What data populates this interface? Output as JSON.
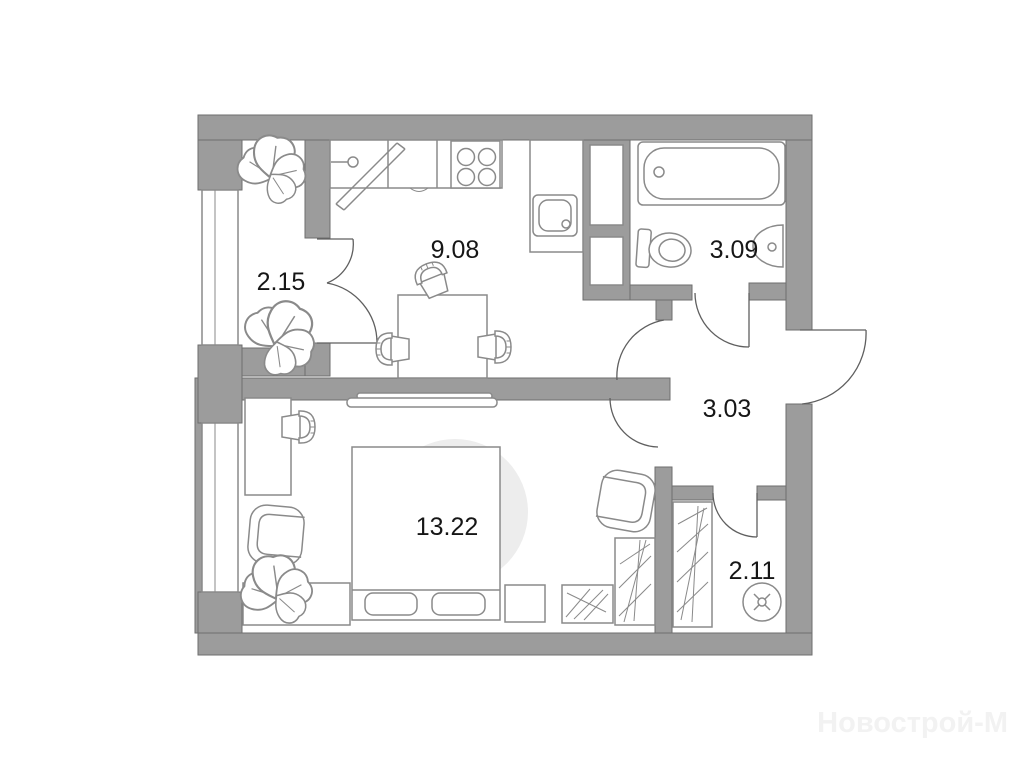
{
  "plan": {
    "type": "apartment-floor-plan",
    "rooms": {
      "balcony": {
        "name": "balcony",
        "area": "2.15"
      },
      "kitchen": {
        "name": "kitchen-living",
        "area": "9.08"
      },
      "bathroom": {
        "name": "bathroom",
        "area": "3.09"
      },
      "hallway": {
        "name": "hallway",
        "area": "3.03"
      },
      "bedroom": {
        "name": "bedroom",
        "area": "13.22"
      },
      "storage": {
        "name": "storage-closet",
        "area": "2.11"
      }
    },
    "fixtures": [
      "bathtub",
      "toilet",
      "wall-sink",
      "stove-4-burner",
      "kitchen-sink",
      "faucet",
      "drying-board",
      "dining-table",
      "chairs",
      "bed",
      "pillows",
      "rug",
      "desk",
      "armchair",
      "tub-chair",
      "wardrobes",
      "dresser",
      "nightstand",
      "washing-machine",
      "plants",
      "windows",
      "door-arcs"
    ],
    "watermark": {
      "text": "Новострой-М"
    },
    "colors": {
      "wall": "#9c9c9c",
      "outline": "#8a8a8a",
      "text": "#161616",
      "rug": "#ededed",
      "watermark": "#f2f2f2",
      "background": "#ffffff"
    }
  }
}
